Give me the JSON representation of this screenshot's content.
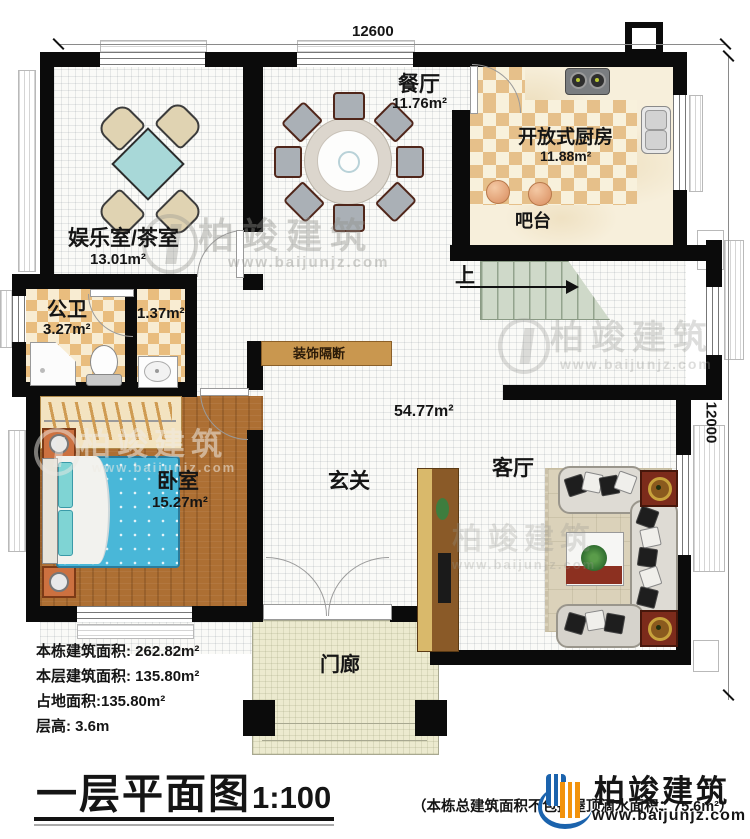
{
  "plan": {
    "dimensions": {
      "top": "12600",
      "right": "12000"
    },
    "rooms": {
      "tea": {
        "name": "娱乐室/茶室",
        "area": "13.01m²"
      },
      "dining": {
        "name": "餐厅",
        "area": "11.76m²"
      },
      "kitchen": {
        "name": "开放式厨房",
        "area": "11.88m²"
      },
      "bar": {
        "name": "吧台"
      },
      "bath": {
        "name": "公卫",
        "area": "3.27m²"
      },
      "anteroom": {
        "area": "1.37m²"
      },
      "bedroom": {
        "name": "卧室",
        "area": "15.27m²"
      },
      "hall": {
        "name": "玄关"
      },
      "living": {
        "name": "客厅",
        "area": "54.77m²"
      },
      "porch": {
        "name": "门廊"
      },
      "partition": {
        "name": "装饰隔断"
      },
      "stairs": {
        "up": "上"
      }
    }
  },
  "info": {
    "line1": "本栋建筑面积: 262.82m²",
    "line2": "本层建筑面积: 135.80m²",
    "line3": "占地面积:135.80m²",
    "line4": "层高: 3.6m"
  },
  "footer": {
    "title": "一层平面图",
    "scale": "1:100",
    "note": "（本栋总建筑面积不包括屋顶滴水面积：75.6m²）"
  },
  "brand": {
    "name": "柏竣建筑",
    "site": "www.baijunjz.com"
  },
  "watermark": {
    "name": "柏竣建筑",
    "site": "www.baijunjz.com"
  },
  "colors": {
    "wall": "#0b0b0b",
    "checker_tan": "#e6c08a",
    "checker_cream": "#f8f1dc",
    "wood": "#ad6f33",
    "bed_blue": "#49b7d8",
    "table_teal": "#a8d8d8",
    "stair_green": "#cfd9c9",
    "porch": "#eceacf",
    "partition_wood": "#c9974f",
    "accent_red": "#7c2b1b",
    "logo_blue": "#1b63ad",
    "logo_orange": "#f2930d"
  }
}
